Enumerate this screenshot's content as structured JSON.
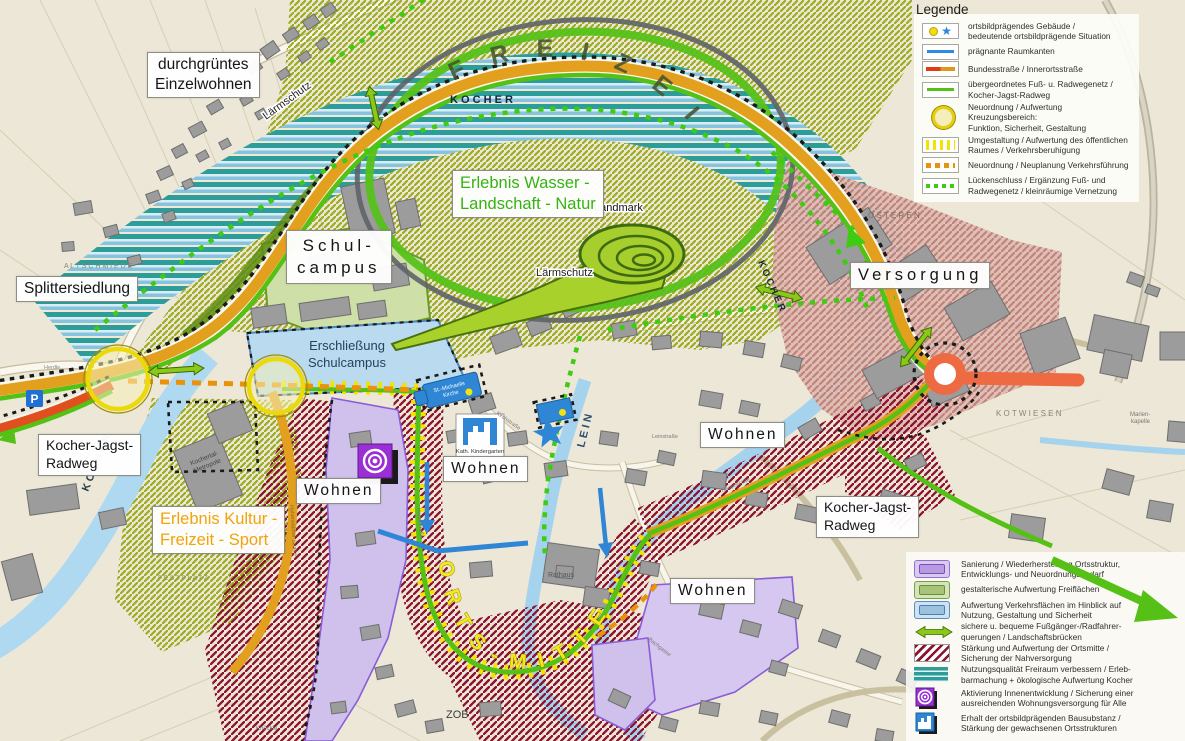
{
  "legend_top": {
    "title": "Legende",
    "items": [
      {
        "icon": "building-star-swatch",
        "label": "ortsbildprägendes Gebäude /\nbedeutende ortsbildprägende Situation"
      },
      {
        "icon": "blue-line-swatch",
        "label": "prägnante Raumkanten"
      },
      {
        "icon": "red-orange-road-swatch",
        "label": "Bundesstraße / Innerortsstraße"
      },
      {
        "icon": "green-line-swatch",
        "label": "übergeordnetes Fuß- u. Radwegenetz /\nKocher-Jagst-Radweg"
      },
      {
        "icon": "yellow-circle-swatch",
        "label": "Neuordnung / Aufwertung Kreuzungsbereich:\nFunktion, Sicherheit, Gestaltung"
      },
      {
        "icon": "yellow-stripes-swatch",
        "label": "Umgestaltung / Aufwertung des öffentlichen\nRaumes / Verkehrsberuhigung"
      },
      {
        "icon": "orange-dashes-swatch",
        "label": "Neuordnung / Neuplanung  Verkehrsführung"
      },
      {
        "icon": "green-dots-swatch",
        "label": "Lückenschluss / Ergänzung Fuß- und\nRadwegenetz / kleinräumige Vernetzung"
      }
    ]
  },
  "legend_bottom": {
    "items": [
      {
        "icon": "purple-area-swatch",
        "label": "Sanierung / Wiederherstellung Ortsstruktur,\nEntwicklungs- und Neuordnungsbedarf"
      },
      {
        "icon": "green-area-swatch",
        "label": "gestalterische Aufwertung Freiflächen"
      },
      {
        "icon": "blue-area-swatch",
        "label": "Aufwertung Verkehrsflächen im Hinblick auf\nNutzung, Gestaltung und Sicherheit"
      },
      {
        "icon": "double-arrow-swatch",
        "label": "sichere u. bequeme Fußgänger-/Radfahrer-\nquerungen / Landschaftsbrücken"
      },
      {
        "icon": "red-hatch-swatch",
        "label": "Stärkung  und Aufwertung der Ortsmitte /\nSicherung der Nahversorgung"
      },
      {
        "icon": "teal-stripes-swatch",
        "label": "Nutzungsqualität Freiraum verbessern / Erleb-\nbarmachung + ökologische Aufwertung Kocher"
      },
      {
        "icon": "purple-rings-icon",
        "label": "Aktivierung Innenentwicklung / Sicherung einer\nausreichenden Wohnungsversorgung für Alle"
      },
      {
        "icon": "blue-building-icon",
        "label": "Erhalt der ortsbildprägenden Bausubstanz /\nStärkung der gewachsenen Ortsstrukturen"
      }
    ]
  },
  "map": {
    "freizeitpark": "F R E I Z E I T P A R K",
    "ortsmitte": "O R T S  -  M I T T E",
    "erlebnis_wasser": "Erlebnis Wasser -\nLandschaft - Natur",
    "erlebnis_kultur": "Erlebnis Kultur -\nFreizeit - Sport",
    "durchgruentes": "durchgrüntes\nEinzelwohnen",
    "splittersiedlung": "Splittersiedlung",
    "schulcampus": "Schul-\ncampus",
    "versorgung": "Versorgung",
    "erschliessung": "Erschließung\nSchulcampus",
    "wohnen": "Wohnen",
    "kocher_jagst_radweg": "Kocher-Jagst-\nRadweg",
    "landmark": "Landmark",
    "laermschutz": "Lärmschutz",
    "kath_kindergarten": "Kath. Kindergarten",
    "st_michaelis_1": "St.-Michaelis",
    "st_michaelis_2": "Kirche",
    "rathaus": "Rathaus",
    "zob": "ZOB",
    "kocher": "K O C H E R",
    "lein": "L E I N",
    "altschmiede": "A L T S C H M I E D E",
    "osteren": "O S T E R E N",
    "kotwiesen": "K O T W I E S E N",
    "festplatz": "F E S T P L A T Z",
    "kochertal_1": "Kochertal-",
    "kochertal_2": "Metropole",
    "marien_1": "Marien-",
    "marien_2": "kapelle",
    "herdle": "Herdle",
    "hauptstrasse": "Hauptstraße",
    "hohenstaedter": "Hohenstädter Straße",
    "bachgasse": "Bachgasse",
    "leinstrasse": "Leinstraße",
    "kirchstrasse": "Kirchstraße",
    "knoeckle": "Knöckle",
    "p_label": "P"
  },
  "colors": {
    "accent_green_route": "#55c015",
    "orange_road": "#e3a01f",
    "red_road": "#e24f1e",
    "tomato_road": "#ee6a42",
    "teal": "#2d9d99",
    "purple_area": "#cfc0ec",
    "dark_red_hatch": "#8c1430",
    "blue_accent": "#2e86d4",
    "yellow_circle": "#e4cf10"
  }
}
